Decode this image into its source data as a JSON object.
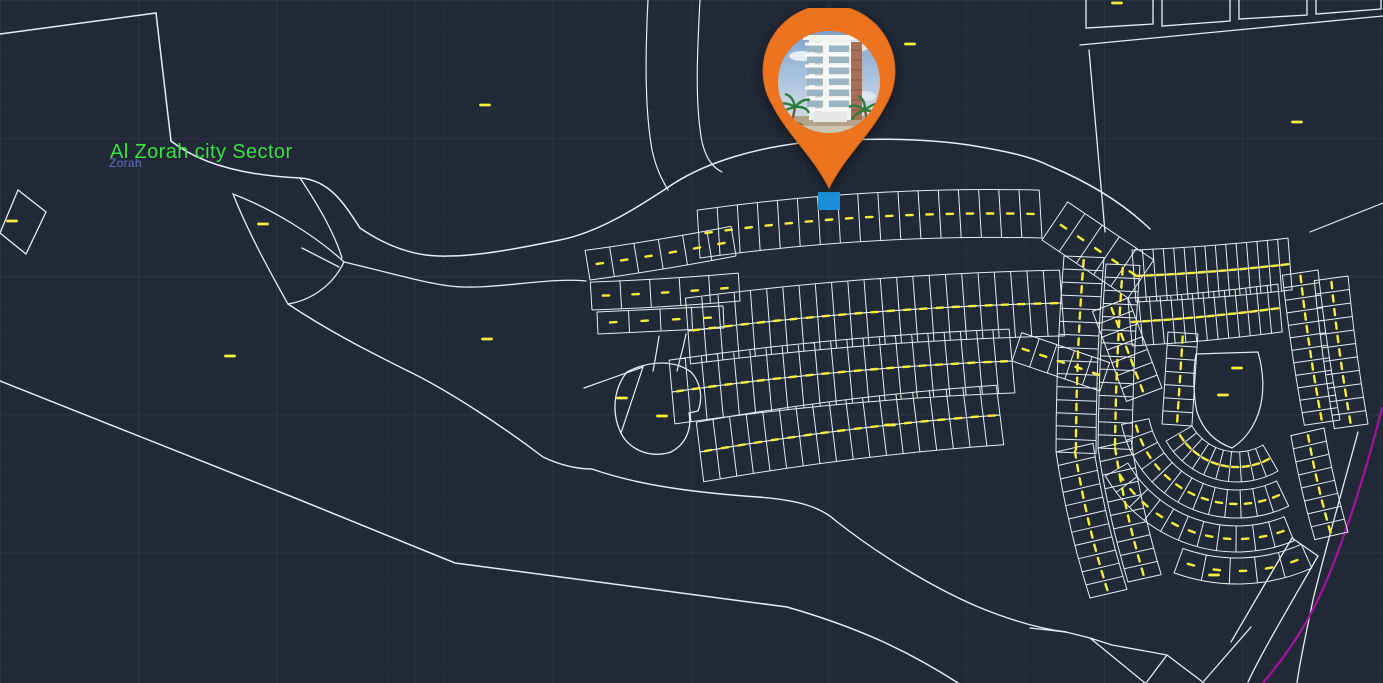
{
  "labels": {
    "main": "Al Zorah city Sector",
    "sub": "Zorah"
  },
  "colors": {
    "background": "#212836",
    "line": "#e9edf3",
    "lot_line": "#e9edf3",
    "dash": "#f2ef3f",
    "magenta": "#a414a0",
    "label_main": "#3be043",
    "label_sub": "#5d6fc2",
    "highlight_plot": "#1b8fd9",
    "pin": "#ec7421"
  },
  "marker": {
    "name": "property-location-pin",
    "points_to": "highlighted plot"
  },
  "map": {
    "highlight": {
      "x": 818,
      "y": 192,
      "w": 22,
      "h": 18
    },
    "paths": [
      {
        "name": "boundary-top-left",
        "d": "M0,34 L156,13 L171,141",
        "w": 1.5
      },
      {
        "name": "main-approach-road-upper",
        "d": "M171,141 C205,168 255,176 300,178 C330,180 345,205 360,228 C395,252 425,257 448,256 C480,256 520,248 560,240 C600,232 640,206 673,184 C710,160 760,148 800,143 C850,138 920,137 975,146 C1010,152 1032,157 1050,166 C1088,182 1122,202 1150,229",
        "w": 1.5
      },
      {
        "name": "road-drop-to-leaf",
        "d": "M300,178 C318,205 334,232 342,258",
        "w": 1.3
      },
      {
        "name": "leaf-parcel",
        "d": "M233,194 C270,208 315,235 344,262 C331,289 307,301 288,304 C270,272 248,232 233,194 Z M302,248 L339,267",
        "w": 1.3
      },
      {
        "name": "main-approach-road-lower",
        "d": "M344,262 C395,274 425,283 450,286 C490,291 545,277 586,281",
        "w": 1.3
      },
      {
        "name": "lagoon-inner-edge",
        "d": "M288,304 C330,332 370,352 406,370 C448,390 505,428 543,457 C562,466 578,469 592,469 C640,486 700,493 758,497 C800,500 822,508 836,521 C878,554 930,586 976,606 C1012,621 1042,629 1066,632",
        "w": 1.4
      },
      {
        "name": "outer-boundary",
        "d": "M0,381 L300,500 L455,563 L787,607 C860,628 910,652 958,683",
        "w": 1.5
      },
      {
        "name": "wedge-blob-connector-road",
        "d": "M659,336 C657,350 655,360 653,371 M686,334 C683,349 680,359 677,371",
        "w": 1.2
      },
      {
        "name": "blob-parcel",
        "d": "M627,372 C652,359 676,361 691,372 C701,383 703,398 698,411 L689,413 C692,429 686,444 671,452 C649,459 628,449 620,431 C612,413 613,389 627,372 Z",
        "w": 1.3
      },
      {
        "name": "blob-side-wedge",
        "d": "M584,388 L643,367 L621,433",
        "w": 1.2
      },
      {
        "name": "small-tilted-parcel-west",
        "d": "M18,190 L46,212 L26,254 L0,233 Z",
        "w": 1.3
      },
      {
        "name": "top-right-parcels",
        "d": "M1086,0 L1086,28 L1153,24 L1153,0 M1162,0 L1162,26 L1230,21 L1230,0 M1239,0 L1239,19 L1307,15 L1307,0 M1316,0 L1316,14 L1381,9 L1381,0",
        "w": 1.3
      },
      {
        "name": "top-right-road",
        "d": "M1080,45 L1383,16",
        "w": 1.3
      },
      {
        "name": "top-right-boundary",
        "d": "M1089,50 L1105,232",
        "w": 1.3
      },
      {
        "name": "top-right-diagonal",
        "d": "M1310,232 L1383,203",
        "w": 1.2
      },
      {
        "name": "north-access-road",
        "d": "M648,0 C645,60 645,110 652,150 C656,168 661,178 668,190 M700,0 C697,55 695,105 702,142 C706,158 712,167 722,172",
        "w": 1.2
      },
      {
        "name": "south-junction-roads",
        "d": "M1030,628 L1066,632 L1090,638 L1112,645 L1167,655 M1090,638 L1145,683 M1167,655 L1146,683 M1167,655 L1204,683 M1251,627 L1204,681",
        "w": 1.3
      },
      {
        "name": "south-curved-road",
        "d": "M1292,538 C1264,585 1243,622 1231,642 M1318,556 C1287,610 1261,654 1248,682 M1292,538 L1318,556",
        "w": 1.3
      },
      {
        "name": "southeast-boundary",
        "d": "M1358,432 C1341,495 1325,550 1313,600 C1306,634 1300,660 1297,683",
        "w": 1.3
      },
      {
        "name": "rounded-park-plot",
        "d": "M1196,354 L1258,352 C1262,366 1264,382 1262,398 C1259,420 1248,438 1232,448 C1215,442 1203,430 1197,412 C1193,394 1193,372 1196,354 Z",
        "w": 1.2
      },
      {
        "name": "sector-limit-magenta",
        "d": "M1382,408 C1367,468 1349,524 1331,570 C1311,620 1289,652 1263,683",
        "w": 2.2,
        "c": "magenta"
      }
    ],
    "strips": [
      {
        "t": "s",
        "p": [
          598,
          334,
          724,
          328
        ],
        "d": -22,
        "n": 4,
        "b": 0,
        "dash": 1
      },
      {
        "t": "s",
        "p": [
          592,
          310,
          740,
          301
        ],
        "d": -28,
        "n": 5,
        "b": 2,
        "dash": 1
      },
      {
        "t": "s",
        "p": [
          590,
          280,
          736,
          256
        ],
        "d": -30,
        "n": 6,
        "b": 2,
        "dash": 1
      },
      {
        "t": "s",
        "p": [
          700,
          258,
          1042,
          238
        ],
        "d": -48,
        "n": 17,
        "b": -14,
        "dash": 1
      },
      {
        "t": "s",
        "p": [
          1042,
          240,
          1128,
          298
        ],
        "d": -46,
        "n": 5,
        "b": 0,
        "dash": 1
      },
      {
        "t": "s",
        "p": [
          688,
          331,
          1062,
          303
        ],
        "d": -33,
        "n": 23,
        "b": -10,
        "dash": 2
      },
      {
        "t": "s",
        "p": [
          688,
          331,
          1062,
          303
        ],
        "d": 33,
        "n": 23,
        "b": -10,
        "dash": 0
      },
      {
        "t": "s",
        "p": [
          672,
          392,
          1012,
          361
        ],
        "d": -32,
        "n": 21,
        "b": -9,
        "dash": 2
      },
      {
        "t": "s",
        "p": [
          672,
          392,
          1012,
          361
        ],
        "d": 32,
        "n": 21,
        "b": -9,
        "dash": 0
      },
      {
        "t": "s",
        "p": [
          1012,
          361,
          1100,
          391
        ],
        "d": -30,
        "n": 5,
        "b": 0,
        "dash": 1
      },
      {
        "t": "s",
        "p": [
          700,
          452,
          1000,
          415
        ],
        "d": -30,
        "n": 18,
        "b": -8,
        "dash": 2
      },
      {
        "t": "s",
        "p": [
          700,
          452,
          1000,
          415
        ],
        "d": 30,
        "n": 18,
        "b": -8,
        "dash": 0
      },
      {
        "t": "s",
        "p": [
          1128,
          298,
          1162,
          388
        ],
        "d": 38,
        "n": 7,
        "b": 0,
        "dash": 1
      },
      {
        "t": "s",
        "p": [
          1064,
          256,
          1056,
          452
        ],
        "d": -40,
        "n": 15,
        "b": 4,
        "dash": 1
      },
      {
        "t": "s",
        "p": [
          1056,
          452,
          1090,
          598
        ],
        "d": -38,
        "n": 11,
        "b": 6,
        "dash": 1
      },
      {
        "t": "s",
        "p": [
          1106,
          264,
          1098,
          448
        ],
        "d": -34,
        "n": 14,
        "b": 3,
        "dash": 1
      },
      {
        "t": "s",
        "p": [
          1098,
          448,
          1128,
          582
        ],
        "d": -34,
        "n": 10,
        "b": 5,
        "dash": 1
      },
      {
        "t": "s",
        "p": [
          1134,
          276,
          1290,
          264
        ],
        "d": -26,
        "n": 15,
        "b": 3,
        "dash": 2
      },
      {
        "t": "s",
        "p": [
          1134,
          276,
          1290,
          264
        ],
        "d": 26,
        "n": 15,
        "b": 3,
        "dash": 0
      },
      {
        "t": "s",
        "p": [
          1130,
          322,
          1280,
          308
        ],
        "d": -24,
        "n": 14,
        "b": 3,
        "dash": 2
      },
      {
        "t": "s",
        "p": [
          1130,
          322,
          1280,
          308
        ],
        "d": 24,
        "n": 14,
        "b": 3,
        "dash": 0
      },
      {
        "t": "s",
        "p": [
          1168,
          332,
          1162,
          424
        ],
        "d": -30,
        "n": 7,
        "b": 0,
        "dash": 1
      },
      {
        "t": "s",
        "p": [
          1318,
          270,
          1340,
          420
        ],
        "d": 36,
        "n": 12,
        "b": 3,
        "dash": 1
      },
      {
        "t": "s",
        "p": [
          1348,
          276,
          1368,
          424
        ],
        "d": 34,
        "n": 11,
        "b": 3,
        "dash": 1
      },
      {
        "t": "s",
        "p": [
          1324,
          428,
          1348,
          532
        ],
        "d": 34,
        "n": 8,
        "b": 3,
        "dash": 1
      },
      {
        "t": "a",
        "c": [
          1237,
          400
        ],
        "r": [
          52,
          82
        ],
        "a": [
          60,
          150
        ],
        "n": 10,
        "dash": 1
      },
      {
        "t": "a",
        "c": [
          1237,
          400
        ],
        "r": [
          90,
          118
        ],
        "a": [
          64,
          168
        ],
        "n": 13,
        "dash": 1
      },
      {
        "t": "a",
        "c": [
          1237,
          400
        ],
        "r": [
          126,
          152
        ],
        "a": [
          68,
          150
        ],
        "n": 11,
        "dash": 1
      },
      {
        "t": "a",
        "c": [
          1237,
          400
        ],
        "r": [
          158,
          184
        ],
        "a": [
          66,
          110
        ],
        "n": 5,
        "dash": 1
      }
    ],
    "loose_dashes": [
      [
        12,
        221
      ],
      [
        263,
        224
      ],
      [
        230,
        356
      ],
      [
        485,
        105
      ],
      [
        487,
        339
      ],
      [
        622,
        398
      ],
      [
        662,
        416
      ],
      [
        890,
        425
      ],
      [
        910,
        44
      ],
      [
        1117,
        3
      ],
      [
        1297,
        122
      ],
      [
        1214,
        575
      ],
      [
        1237,
        368
      ],
      [
        1223,
        395
      ]
    ]
  }
}
